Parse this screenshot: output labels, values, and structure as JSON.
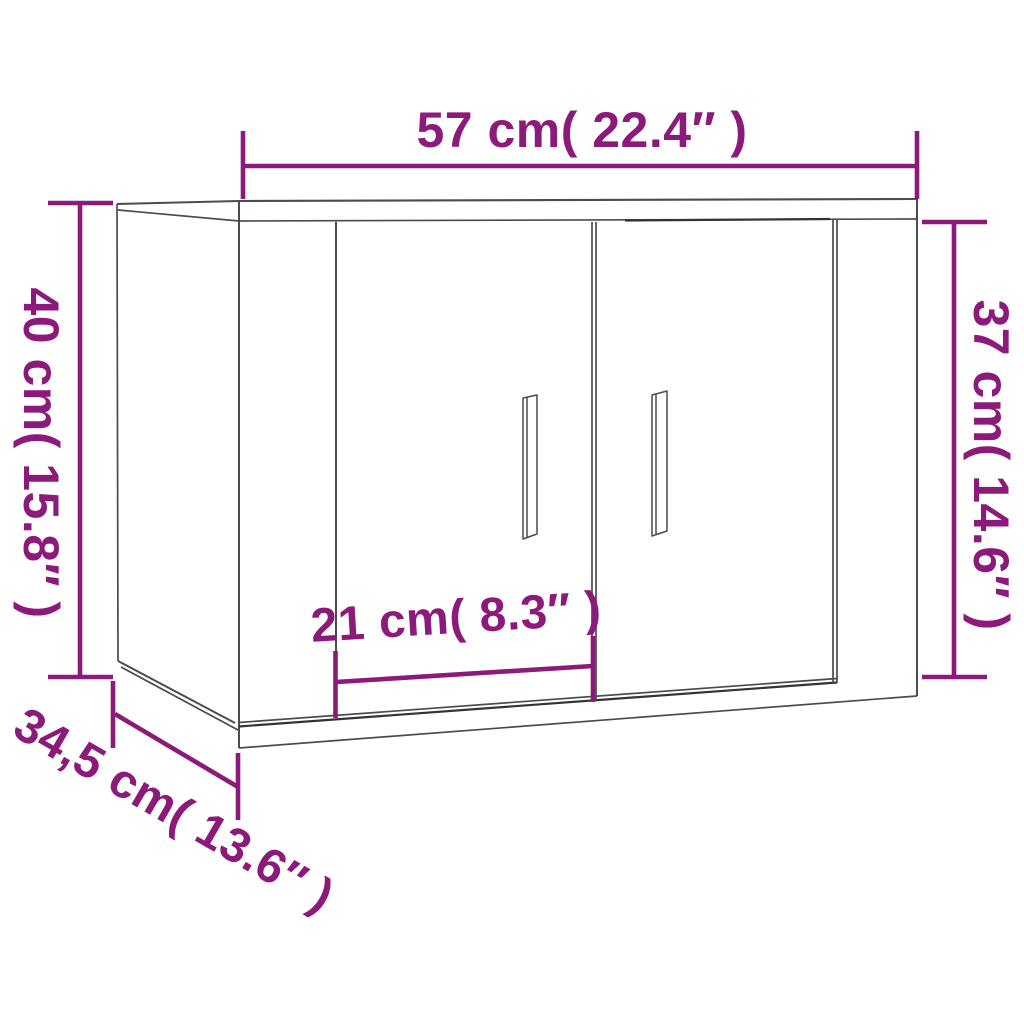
{
  "diagram": {
    "depicts": "two-door wall-mounted cabinet shown in perspective with dimension lines"
  },
  "dimensions": {
    "top_width": {
      "label": "57 cm( 22.4″ )",
      "value_cm": "57",
      "value_in": "22.4"
    },
    "left_height": {
      "label": "40 cm( 15.8″ )",
      "value_cm": "40",
      "value_in": "15.8"
    },
    "right_height": {
      "label": "37 cm( 14.6″ )",
      "value_cm": "37",
      "value_in": "14.6"
    },
    "door_width": {
      "label": "21 cm( 8.3″ )",
      "value_cm": "21",
      "value_in": "8.3"
    },
    "depth": {
      "label": "34,5 cm( 13.6″ )",
      "value_cm": "34,5",
      "value_in": "13.6"
    }
  },
  "colors": {
    "dimension_accent": "#8C1A7B",
    "cabinet_outline": "#4C4C4C",
    "cabinet_outline_dark": "#333333",
    "background": "#FFFFFF"
  }
}
